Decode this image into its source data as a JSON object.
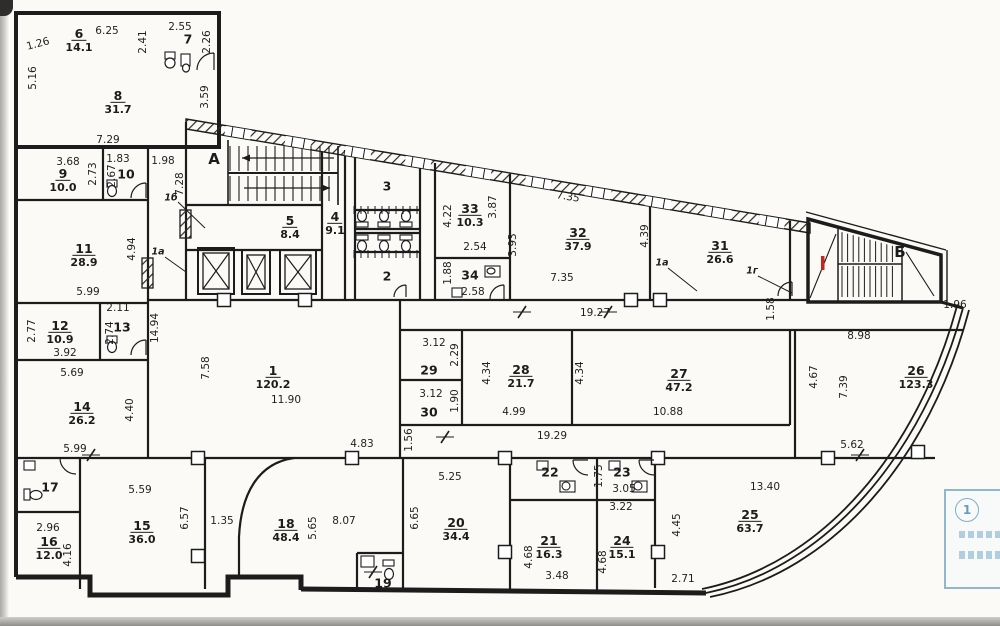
{
  "colors": {
    "ink": "#1c1c1c",
    "red_mark": "#c6261e",
    "stamp_blue": "#7fb0c6",
    "paper": "#fbfaf6"
  },
  "stamp": {
    "circle_label": "1"
  },
  "stairwells": [
    {
      "t": "А",
      "x": 214,
      "y": 159
    },
    {
      "t": "Б",
      "x": 900,
      "y": 252
    }
  ],
  "ref_labels": [
    {
      "t": "1б",
      "x": 171,
      "y": 198
    },
    {
      "t": "1а",
      "x": 158,
      "y": 252
    },
    {
      "t": "1а",
      "x": 662,
      "y": 263
    },
    {
      "t": "1г",
      "x": 752,
      "y": 271
    }
  ],
  "red_marks": [
    {
      "x": 821,
      "y": 256
    }
  ],
  "rooms": [
    {
      "n": "1",
      "a": "120.2",
      "x": 273,
      "y": 376
    },
    {
      "n": "2",
      "a": "",
      "x": 387,
      "y": 276
    },
    {
      "n": "3",
      "a": "",
      "x": 387,
      "y": 186
    },
    {
      "n": "4",
      "a": "9.1",
      "x": 335,
      "y": 222
    },
    {
      "n": "5",
      "a": "8.4",
      "x": 290,
      "y": 226
    },
    {
      "n": "6",
      "a": "14.1",
      "x": 79,
      "y": 39
    },
    {
      "n": "7",
      "a": "",
      "x": 188,
      "y": 39
    },
    {
      "n": "8",
      "a": "31.7",
      "x": 118,
      "y": 101
    },
    {
      "n": "9",
      "a": "10.0",
      "x": 63,
      "y": 179
    },
    {
      "n": "10",
      "a": "",
      "x": 126,
      "y": 174
    },
    {
      "n": "11",
      "a": "28.9",
      "x": 84,
      "y": 254
    },
    {
      "n": "12",
      "a": "10.9",
      "x": 60,
      "y": 331
    },
    {
      "n": "13",
      "a": "",
      "x": 122,
      "y": 327
    },
    {
      "n": "14",
      "a": "26.2",
      "x": 82,
      "y": 412
    },
    {
      "n": "15",
      "a": "36.0",
      "x": 142,
      "y": 531
    },
    {
      "n": "16",
      "a": "12.0",
      "x": 49,
      "y": 547
    },
    {
      "n": "17",
      "a": "",
      "x": 50,
      "y": 487
    },
    {
      "n": "18",
      "a": "48.4",
      "x": 286,
      "y": 529
    },
    {
      "n": "19",
      "a": "",
      "x": 383,
      "y": 583
    },
    {
      "n": "20",
      "a": "34.4",
      "x": 456,
      "y": 528
    },
    {
      "n": "21",
      "a": "16.3",
      "x": 549,
      "y": 546
    },
    {
      "n": "22",
      "a": "",
      "x": 550,
      "y": 472
    },
    {
      "n": "23",
      "a": "",
      "x": 622,
      "y": 472
    },
    {
      "n": "24",
      "a": "15.1",
      "x": 622,
      "y": 546
    },
    {
      "n": "25",
      "a": "63.7",
      "x": 750,
      "y": 520
    },
    {
      "n": "26",
      "a": "123.3",
      "x": 916,
      "y": 376
    },
    {
      "n": "27",
      "a": "47.2",
      "x": 679,
      "y": 379
    },
    {
      "n": "28",
      "a": "21.7",
      "x": 521,
      "y": 375
    },
    {
      "n": "29",
      "a": "",
      "x": 429,
      "y": 370
    },
    {
      "n": "30",
      "a": "",
      "x": 429,
      "y": 412
    },
    {
      "n": "31",
      "a": "26.6",
      "x": 720,
      "y": 251
    },
    {
      "n": "32",
      "a": "37.9",
      "x": 578,
      "y": 238
    },
    {
      "n": "33",
      "a": "10.3",
      "x": 470,
      "y": 214
    },
    {
      "n": "34",
      "a": "",
      "x": 470,
      "y": 275
    }
  ],
  "dims": [
    {
      "t": "6.25",
      "x": 107,
      "y": 31
    },
    {
      "t": "1.26",
      "x": 38,
      "y": 44,
      "r": -15
    },
    {
      "t": "2.41",
      "x": 143,
      "y": 42,
      "v": 1
    },
    {
      "t": "2.55",
      "x": 180,
      "y": 27
    },
    {
      "t": "2.26",
      "x": 207,
      "y": 42,
      "v": 1
    },
    {
      "t": "5.16",
      "x": 33,
      "y": 78,
      "v": 1
    },
    {
      "t": "3.59",
      "x": 205,
      "y": 97,
      "v": 1
    },
    {
      "t": "7.29",
      "x": 108,
      "y": 140
    },
    {
      "t": "3.68",
      "x": 68,
      "y": 162
    },
    {
      "t": "2.73",
      "x": 93,
      "y": 174,
      "v": 1
    },
    {
      "t": "1.83",
      "x": 118,
      "y": 159
    },
    {
      "t": "2.67",
      "x": 112,
      "y": 176,
      "v": 1
    },
    {
      "t": "1.98",
      "x": 163,
      "y": 161
    },
    {
      "t": "7.28",
      "x": 180,
      "y": 184,
      "v": 1
    },
    {
      "t": "4.94",
      "x": 132,
      "y": 249,
      "v": 1
    },
    {
      "t": "5.99",
      "x": 88,
      "y": 292
    },
    {
      "t": "2.11",
      "x": 118,
      "y": 308
    },
    {
      "t": "2.77",
      "x": 32,
      "y": 331,
      "v": 1
    },
    {
      "t": "3.92",
      "x": 65,
      "y": 353
    },
    {
      "t": "2.74",
      "x": 110,
      "y": 333,
      "v": 1
    },
    {
      "t": "14.94",
      "x": 155,
      "y": 328,
      "v": 1
    },
    {
      "t": "5.69",
      "x": 72,
      "y": 373
    },
    {
      "t": "4.40",
      "x": 130,
      "y": 410,
      "v": 1
    },
    {
      "t": "7.58",
      "x": 206,
      "y": 368,
      "v": 1
    },
    {
      "t": "5.99",
      "x": 75,
      "y": 449
    },
    {
      "t": "5.59",
      "x": 140,
      "y": 490
    },
    {
      "t": "2.96",
      "x": 48,
      "y": 528
    },
    {
      "t": "4.16",
      "x": 68,
      "y": 555,
      "v": 1
    },
    {
      "t": "6.57",
      "x": 185,
      "y": 518,
      "v": 1
    },
    {
      "t": "1.35",
      "x": 222,
      "y": 521
    },
    {
      "t": "4.22",
      "x": 448,
      "y": 216,
      "v": 1
    },
    {
      "t": "3.87",
      "x": 493,
      "y": 207,
      "v": 1
    },
    {
      "t": "2.54",
      "x": 475,
      "y": 247
    },
    {
      "t": "3.93",
      "x": 513,
      "y": 245,
      "v": 1
    },
    {
      "t": "1.88",
      "x": 448,
      "y": 273,
      "v": 1
    },
    {
      "t": "2.58",
      "x": 473,
      "y": 292
    },
    {
      "t": "7.35",
      "x": 568,
      "y": 197,
      "r": 9
    },
    {
      "t": "7.35",
      "x": 562,
      "y": 278
    },
    {
      "t": "4.39",
      "x": 645,
      "y": 236,
      "v": 1
    },
    {
      "t": "19.27",
      "x": 595,
      "y": 313
    },
    {
      "t": "1.58",
      "x": 771,
      "y": 309,
      "v": 1
    },
    {
      "t": "1.96",
      "x": 955,
      "y": 305
    },
    {
      "t": "3.12",
      "x": 434,
      "y": 343
    },
    {
      "t": "2.29",
      "x": 455,
      "y": 355,
      "v": 1
    },
    {
      "t": "3.12",
      "x": 431,
      "y": 394
    },
    {
      "t": "1.90",
      "x": 455,
      "y": 401,
      "v": 1
    },
    {
      "t": "1.56",
      "x": 409,
      "y": 440,
      "v": 1
    },
    {
      "t": "4.34",
      "x": 487,
      "y": 373,
      "v": 1
    },
    {
      "t": "4.99",
      "x": 514,
      "y": 412
    },
    {
      "t": "4.34",
      "x": 580,
      "y": 373,
      "v": 1
    },
    {
      "t": "10.88",
      "x": 668,
      "y": 412
    },
    {
      "t": "19.29",
      "x": 552,
      "y": 436
    },
    {
      "t": "11.90",
      "x": 286,
      "y": 400
    },
    {
      "t": "4.83",
      "x": 362,
      "y": 444
    },
    {
      "t": "8.98",
      "x": 859,
      "y": 336
    },
    {
      "t": "4.67",
      "x": 814,
      "y": 377,
      "v": 1
    },
    {
      "t": "7.39",
      "x": 844,
      "y": 387,
      "v": 1
    },
    {
      "t": "5.62",
      "x": 852,
      "y": 445
    },
    {
      "t": "5.65",
      "x": 313,
      "y": 528,
      "v": 1
    },
    {
      "t": "8.07",
      "x": 344,
      "y": 521
    },
    {
      "t": "6.65",
      "x": 415,
      "y": 518,
      "v": 1
    },
    {
      "t": "5.25",
      "x": 450,
      "y": 477
    },
    {
      "t": "1.75",
      "x": 599,
      "y": 476,
      "v": 1
    },
    {
      "t": "3.05",
      "x": 624,
      "y": 489
    },
    {
      "t": "3.22",
      "x": 621,
      "y": 507
    },
    {
      "t": "4.68",
      "x": 529,
      "y": 557,
      "v": 1
    },
    {
      "t": "3.48",
      "x": 557,
      "y": 576
    },
    {
      "t": "4.68",
      "x": 603,
      "y": 562,
      "v": 1
    },
    {
      "t": "4.45",
      "x": 677,
      "y": 525,
      "v": 1
    },
    {
      "t": "2.71",
      "x": 683,
      "y": 579
    },
    {
      "t": "13.40",
      "x": 765,
      "y": 487
    }
  ]
}
